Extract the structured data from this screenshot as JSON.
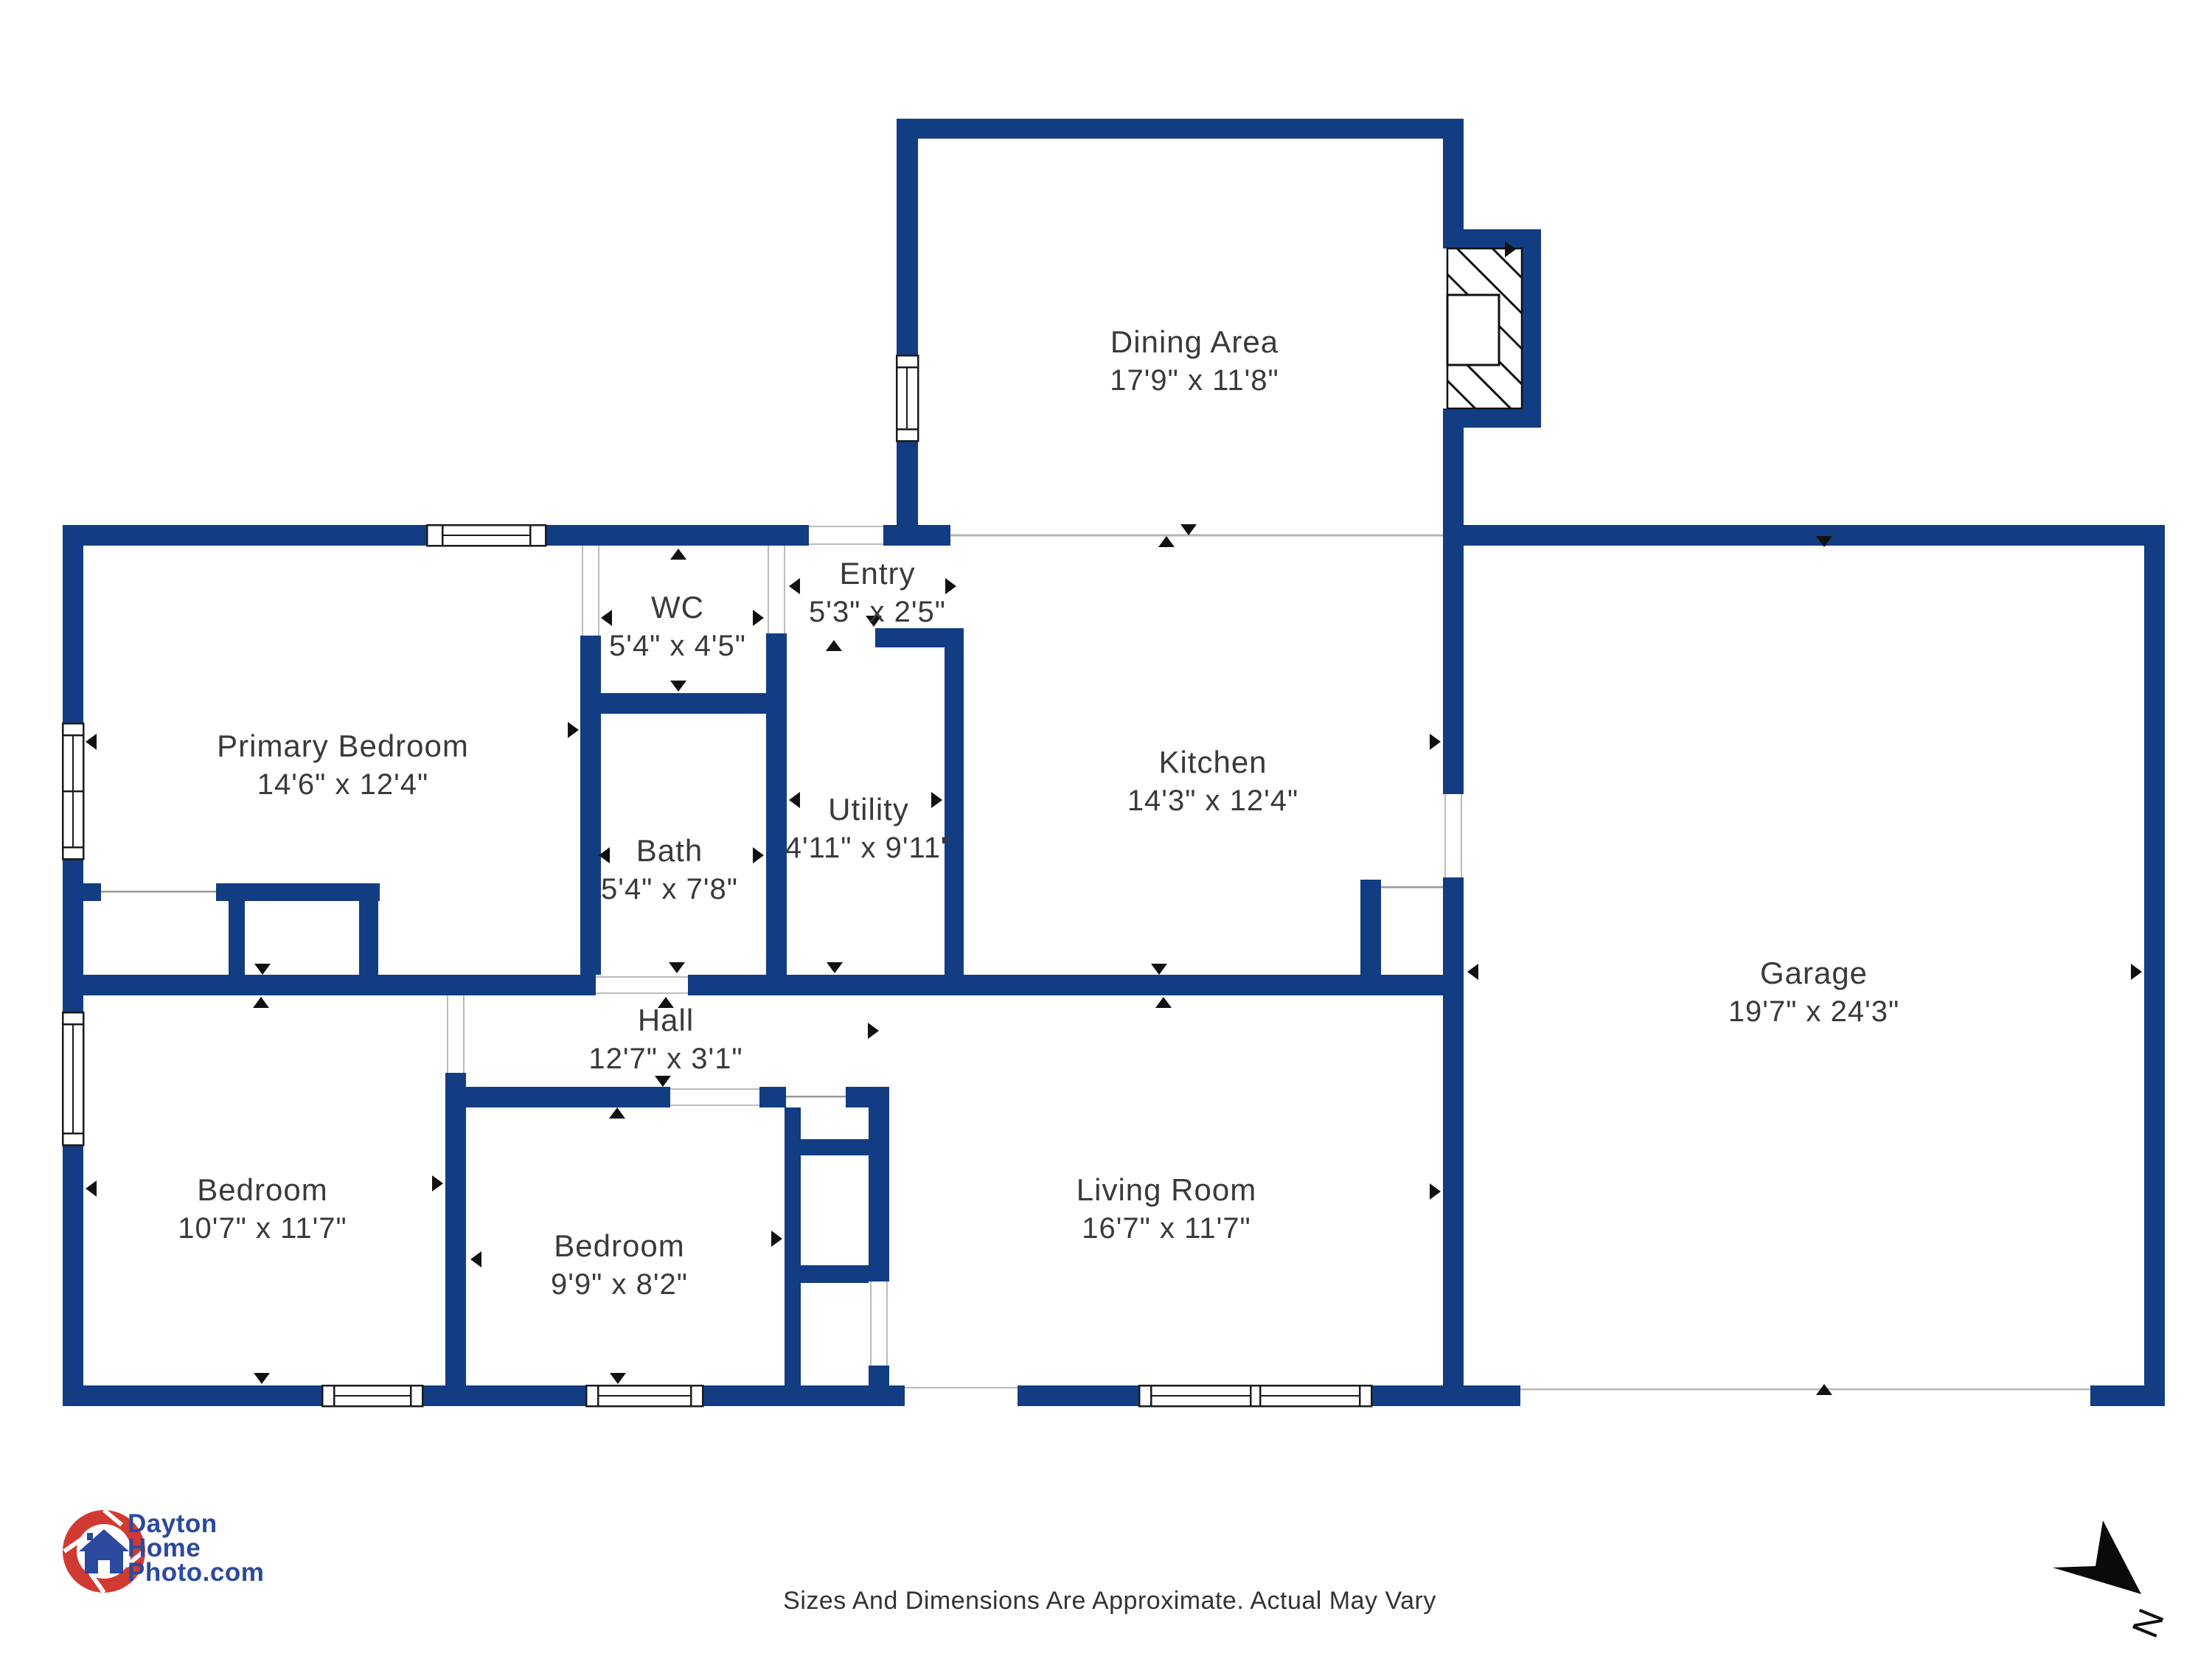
{
  "plan": {
    "rooms": [
      {
        "id": "dining-area",
        "name": "Dining Area",
        "dims": "17'9\" x 11'8\""
      },
      {
        "id": "entry",
        "name": "Entry",
        "dims": "5'3\" x 2'5\""
      },
      {
        "id": "wc",
        "name": "WC",
        "dims": "5'4\" x 4'5\""
      },
      {
        "id": "primary-bedroom",
        "name": "Primary Bedroom",
        "dims": "14'6\" x 12'4\""
      },
      {
        "id": "kitchen",
        "name": "Kitchen",
        "dims": "14'3\" x 12'4\""
      },
      {
        "id": "bath",
        "name": "Bath",
        "dims": "5'4\" x 7'8\""
      },
      {
        "id": "utility",
        "name": "Utility",
        "dims": "4'11\" x 9'11\""
      },
      {
        "id": "garage",
        "name": "Garage",
        "dims": "19'7\" x 24'3\""
      },
      {
        "id": "hall",
        "name": "Hall",
        "dims": "12'7\" x 3'1\""
      },
      {
        "id": "bedroom-left",
        "name": "Bedroom",
        "dims": "10'7\" x 11'7\""
      },
      {
        "id": "bedroom-middle",
        "name": "Bedroom",
        "dims": "9'9\" x 8'2\""
      },
      {
        "id": "living-room",
        "name": "Living Room",
        "dims": "16'7\" x 11'7\""
      }
    ],
    "colors": {
      "wall": "#123D82",
      "logo_red": "#D13A32",
      "logo_blue": "#2B4A9D"
    }
  },
  "branding": {
    "logo_icon": "camera-shutter-house-icon",
    "logo_lines": [
      "Dayton",
      "Home",
      "Photo.com"
    ]
  },
  "footer": {
    "disclaimer": "Sizes And Dimensions Are Approximate. Actual May Vary"
  },
  "compass": {
    "label": "N"
  }
}
